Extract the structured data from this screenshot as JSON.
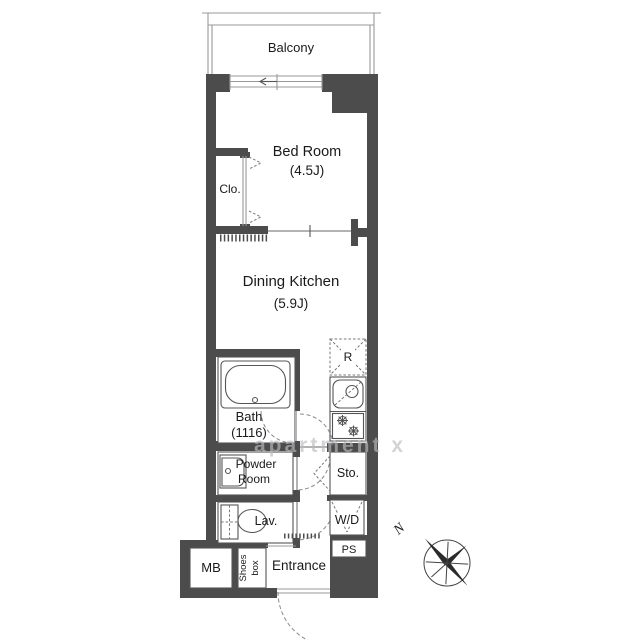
{
  "floor_plan": {
    "balcony_label": "Balcony",
    "bedroom": {
      "name": "Bed Room",
      "size": "(4.5J)"
    },
    "closet_label": "Clo.",
    "dining_kitchen": {
      "name": "Dining Kitchen",
      "size": "(5.9J)"
    },
    "bath": {
      "name": "Bath",
      "size": "(1116)"
    },
    "powder_room": {
      "line1": "Powder",
      "line2": "Room"
    },
    "lavatory_label": "Lav.",
    "storage_label": "Sto.",
    "washer_dryer_label": "W/D",
    "pipe_space_label": "PS",
    "meter_box_label": "MB",
    "shoes_box": {
      "line1": "Shoes",
      "line2": "box"
    },
    "entrance_label": "Entrance",
    "refrigerator_label": "R",
    "compass_north_label": "N",
    "watermark": "apartment x",
    "colors": {
      "wall": "#4c4c4c",
      "fixture_line": "#555555",
      "light_line": "#999999",
      "text": "#1a1a1a",
      "watermark": "#bcbcc2"
    }
  }
}
